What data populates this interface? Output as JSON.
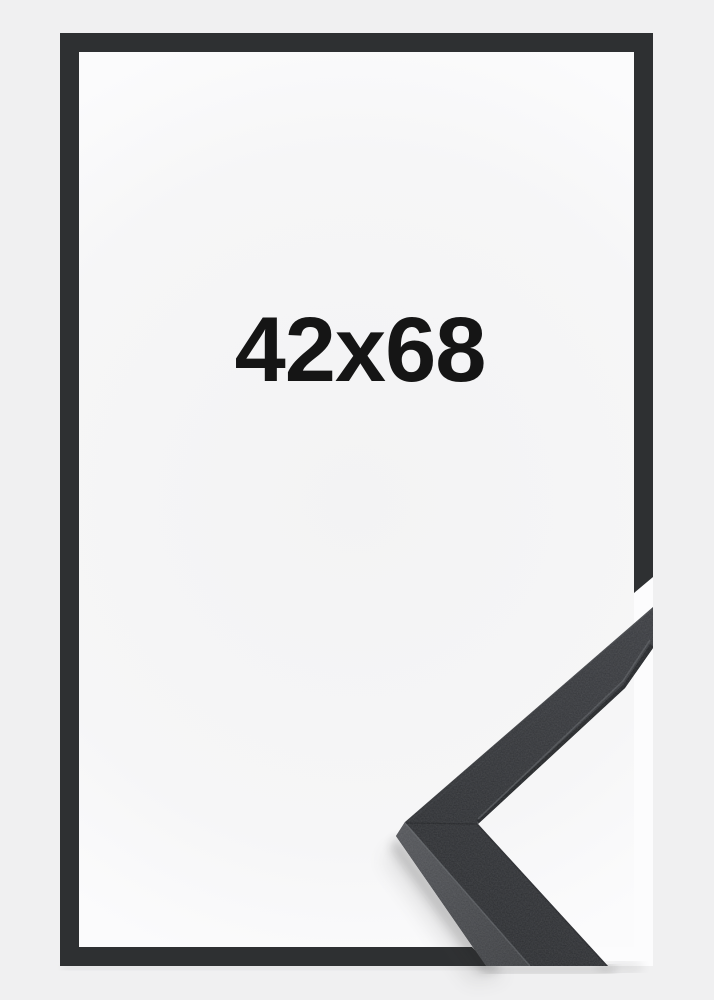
{
  "frame_product": {
    "size_label": "42x68",
    "colors": {
      "page_background": "#f0f0f1",
      "interior_center": "#f3f3f4",
      "interior_mid": "#f6f6f7",
      "interior_edge": "#fbfbfc",
      "outline_dark": "#2e3032",
      "photo_background": "#fcfcfd",
      "moulding_top_light": "#3a3c40",
      "moulding_top_dark": "#2b2d30",
      "moulding_side_light": "#54565a",
      "moulding_side_dark": "#3e4043",
      "label_text": "#151515"
    }
  }
}
